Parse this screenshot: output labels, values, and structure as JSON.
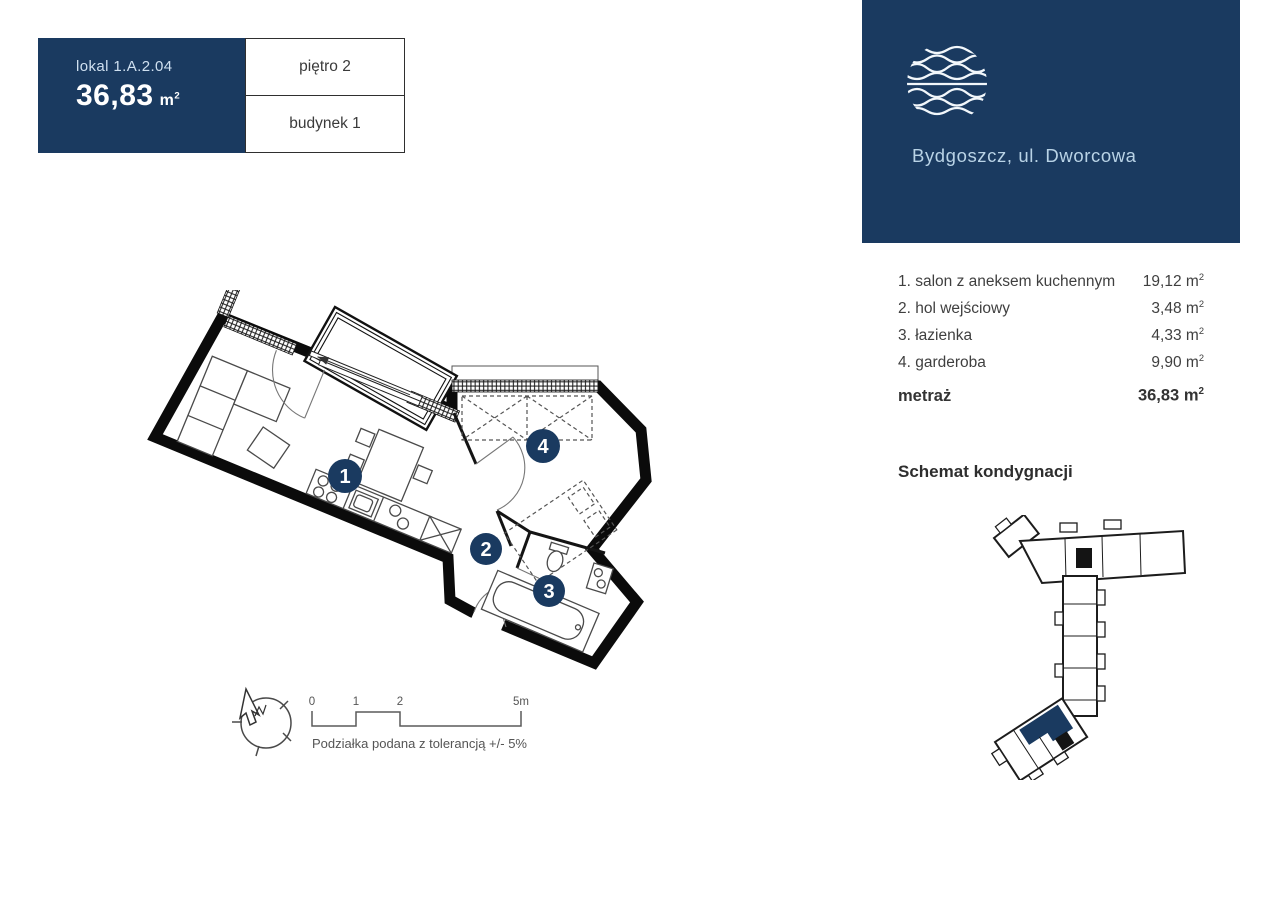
{
  "header": {
    "unit_label": "lokal 1.A.2.04",
    "area_value": "36,83",
    "unit_m": "m",
    "unit_exp": "2",
    "floor_label": "piętro 2",
    "building_label": "budynek 1"
  },
  "brand": {
    "location": "Bydgoszcz, ul. Dworcowa"
  },
  "legend": {
    "rooms": [
      {
        "name": "1. salon z aneksem kuchennym",
        "area": "19,12"
      },
      {
        "name": "2. hol wejściowy",
        "area": "3,48"
      },
      {
        "name": "3. łazienka",
        "area": "4,33"
      },
      {
        "name": "4. garderoba",
        "area": "9,90"
      }
    ],
    "total_label": "metraż",
    "total_area": "36,83",
    "unit_m": "m",
    "unit_exp": "2"
  },
  "schematic_title": "Schemat kondygnacji",
  "plan_markers": [
    "1",
    "2",
    "3",
    "4"
  ],
  "scalebar": {
    "ticks": [
      "0",
      "1",
      "2",
      "5m"
    ],
    "note": "Podziałka podana z tolerancją +/- 5%"
  },
  "colors": {
    "navy": "#1a3a60",
    "light_blue": "#b9d3e6",
    "ink": "#3f3f3f"
  }
}
